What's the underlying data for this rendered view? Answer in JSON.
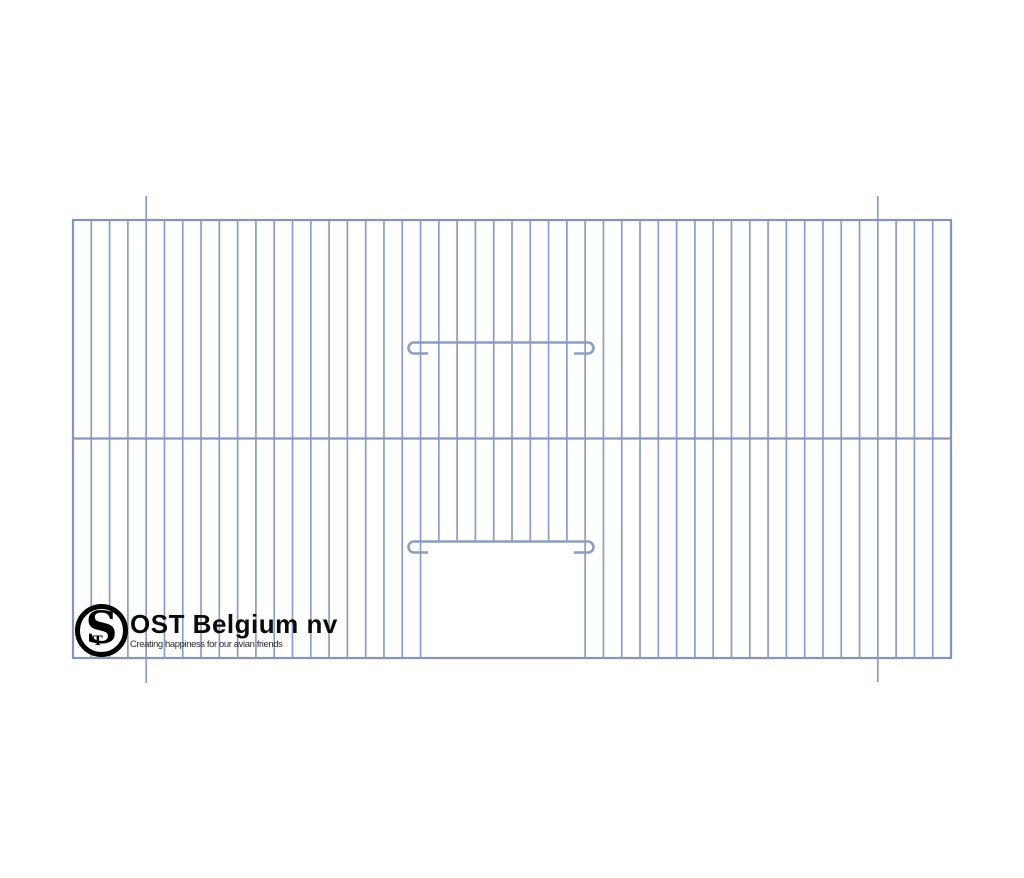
{
  "canvas": {
    "width": 1024,
    "height": 878,
    "background": "#ffffff"
  },
  "drawing": {
    "description": "cage-front-panel-wire-grid-with-door",
    "wire_color": "#8C9EC0",
    "frame_color": "#8596B9",
    "wire_stroke_width": 1.7,
    "frame_stroke_width": 2.2,
    "bar_stroke_width": 2.6,
    "panel": {
      "left": 73,
      "top": 220,
      "right": 951,
      "bottom": 658
    },
    "divider_y": 438.5,
    "wire_gap_count": 48,
    "door": {
      "left_wire_index": 19,
      "right_wire_index": 28,
      "top_y": 541.5,
      "masked_wires_from": 20,
      "masked_wires_to": 27
    },
    "clip_bars": [
      {
        "name": "upper-hook-bar",
        "y": 342.5,
        "x1": 414,
        "x2": 588,
        "hook_radius": 5.5,
        "hook_depth": 11,
        "tail": 14
      },
      {
        "name": "door-hook-bar",
        "y": 541.5,
        "x1": 414,
        "x2": 588,
        "hook_radius": 5.5,
        "hook_depth": 11,
        "tail": 14
      }
    ],
    "crop_marks": [
      {
        "x": 146.2,
        "y1": 196,
        "y2": 220
      },
      {
        "x": 877.8,
        "y1": 196,
        "y2": 220
      },
      {
        "x": 146.2,
        "y1": 658,
        "y2": 683
      },
      {
        "x": 877.8,
        "y1": 658,
        "y2": 682
      }
    ]
  },
  "logo": {
    "monogram": {
      "s": "S",
      "t": "T"
    },
    "brand": "OST Belgium nv",
    "tagline": "Creating happiness for our avian friends",
    "text_color": "#0b0b0b"
  }
}
